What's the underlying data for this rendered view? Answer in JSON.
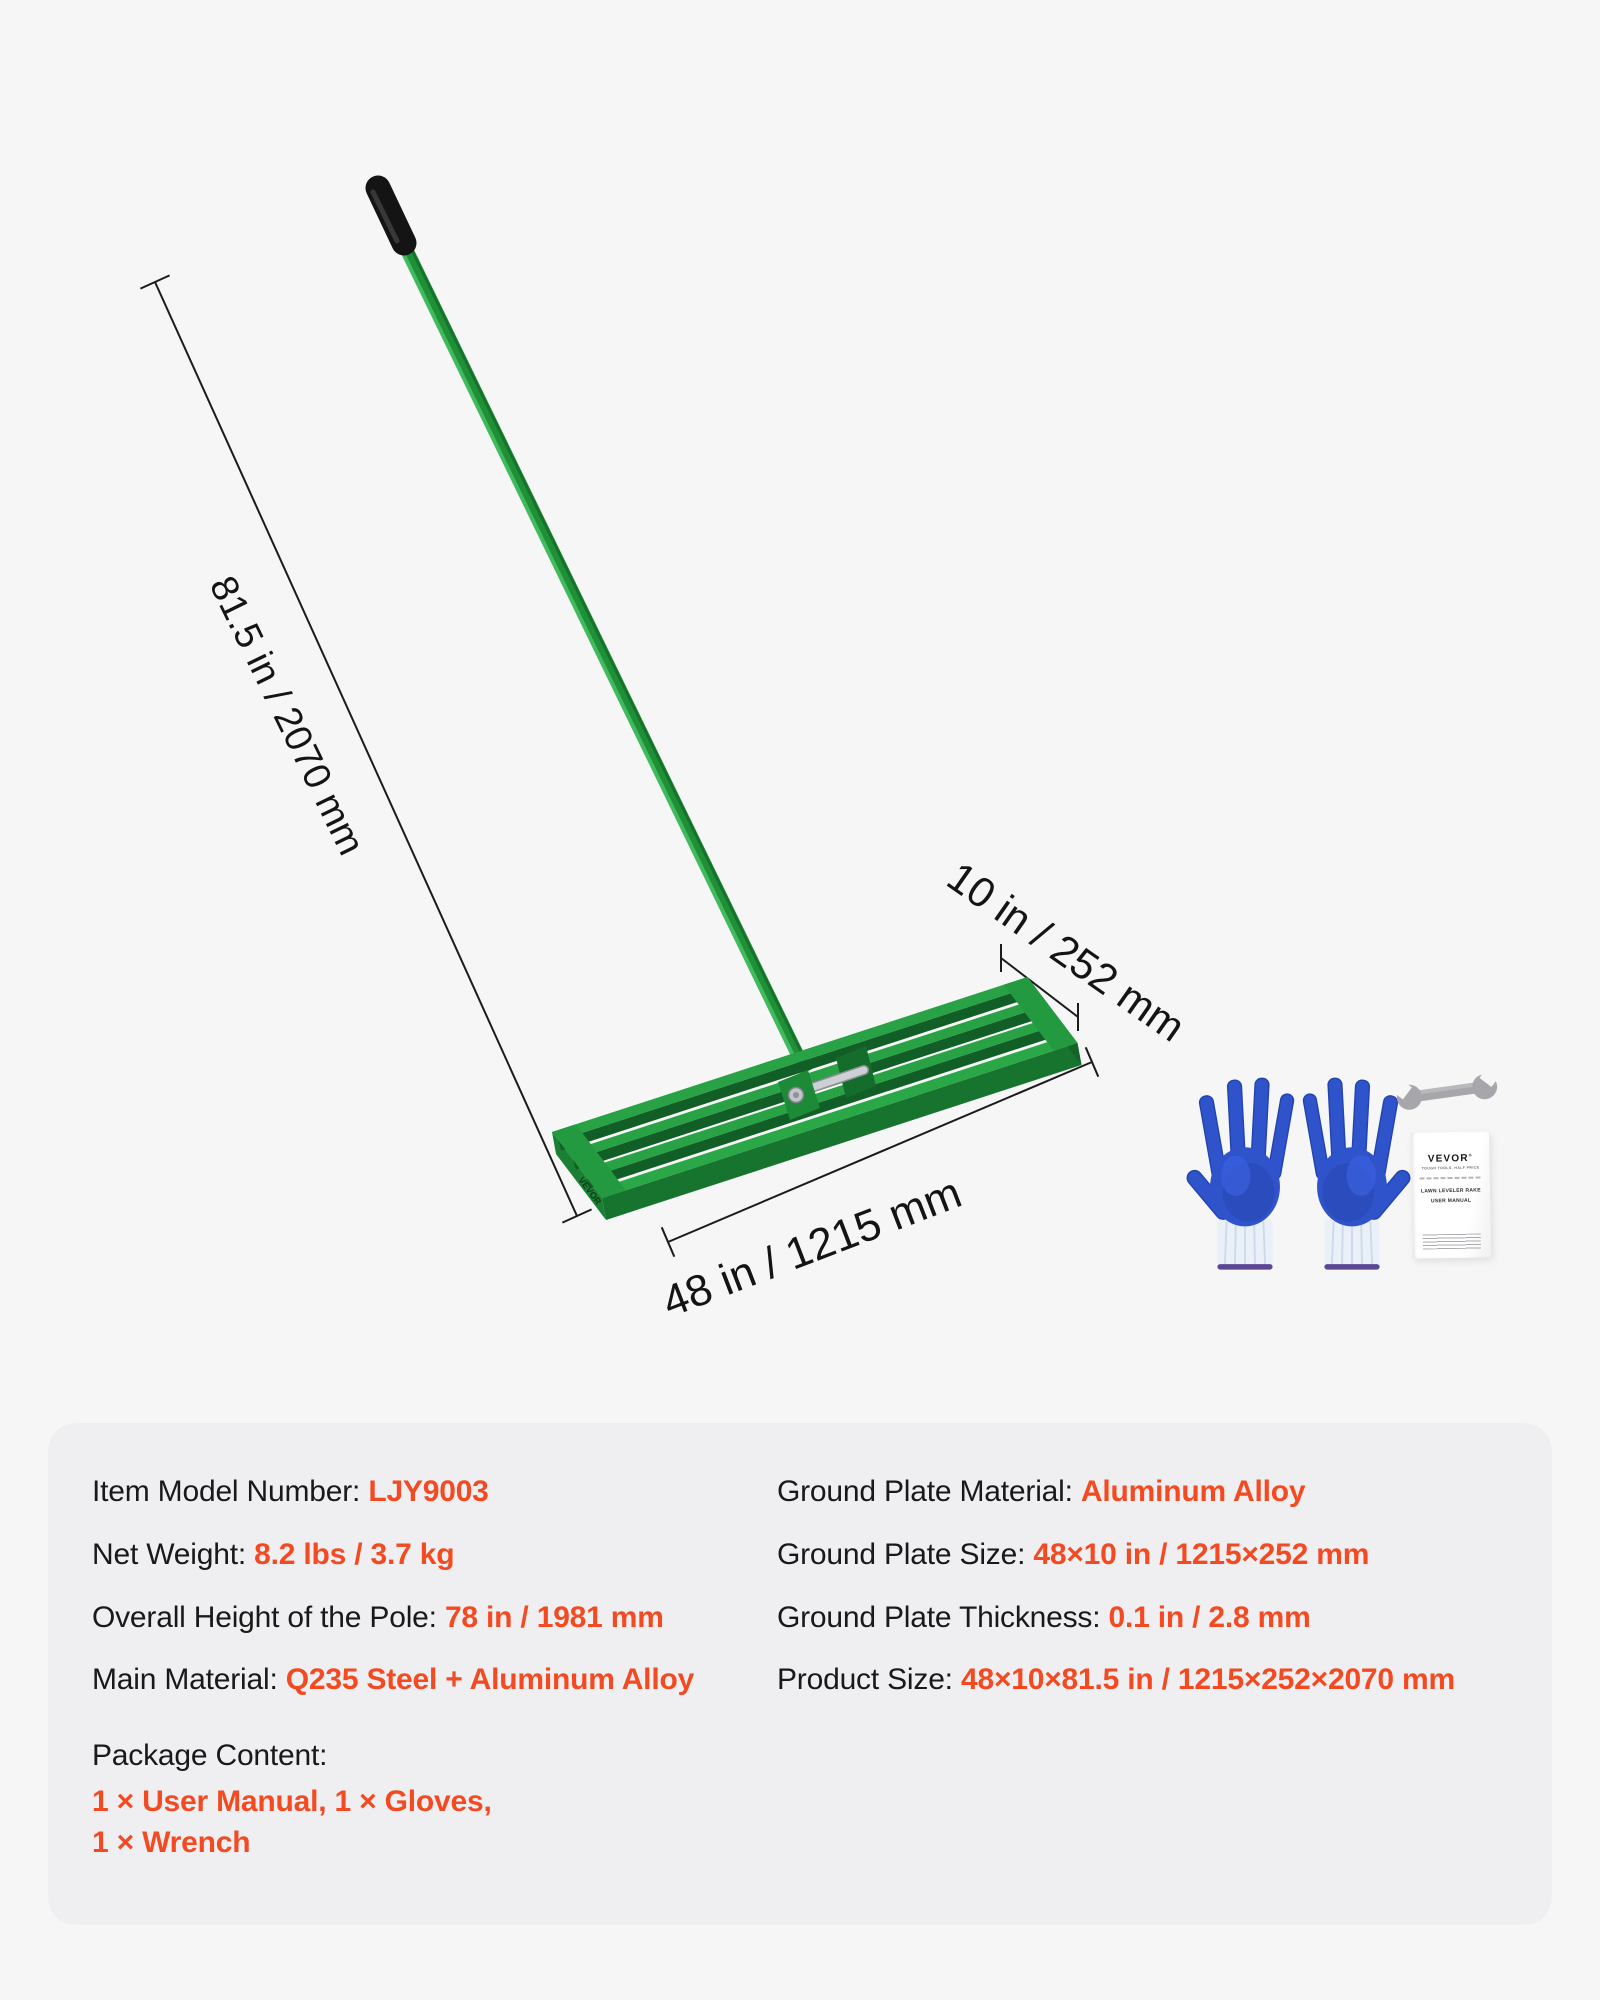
{
  "colors": {
    "accent_orange": "#f34a22",
    "rake_green_top": "#28a244",
    "rake_green_dark": "#15702b",
    "handle_green": "#1f9038",
    "glove_blue": "#2e53cb",
    "panel_gray": "#efeff1",
    "page_bg": "#f6f6f6"
  },
  "diagram": {
    "dim_height": {
      "label": "81.5 in / 2070 mm"
    },
    "dim_depth": {
      "label": "10 in / 252 mm"
    },
    "dim_width": {
      "label": "48 in / 1215 mm"
    },
    "plate_logo": "VEVOR"
  },
  "accessories": {
    "manual": {
      "brand": "VEVOR",
      "registered": "®",
      "tagline": "TOUGH TOOLS, HALF PRICE",
      "title_line1": "LAWN LEVELER RAKE",
      "title_line2": "USER MANUAL"
    }
  },
  "specs": {
    "left": [
      {
        "label": "Item Model Number:",
        "value": "LJY9003"
      },
      {
        "label": "Net Weight:",
        "value": "8.2 lbs / 3.7 kg"
      },
      {
        "label": "Overall Height of the Pole:",
        "value": "78 in / 1981 mm"
      },
      {
        "label": "Main Material:",
        "value": "Q235 Steel + Aluminum Alloy"
      }
    ],
    "package": {
      "label": "Package Content:",
      "line1": "1 × User Manual, 1 × Gloves,",
      "line2": "1 × Wrench"
    },
    "right": [
      {
        "label": "Ground Plate Material:",
        "value": "Aluminum Alloy"
      },
      {
        "label": "Ground Plate Size:",
        "value": "48×10 in / 1215×252 mm"
      },
      {
        "label": "Ground Plate Thickness:",
        "value": "0.1 in / 2.8 mm"
      },
      {
        "label": "Product Size:",
        "value": "48×10×81.5 in / 1215×252×2070 mm"
      }
    ]
  }
}
